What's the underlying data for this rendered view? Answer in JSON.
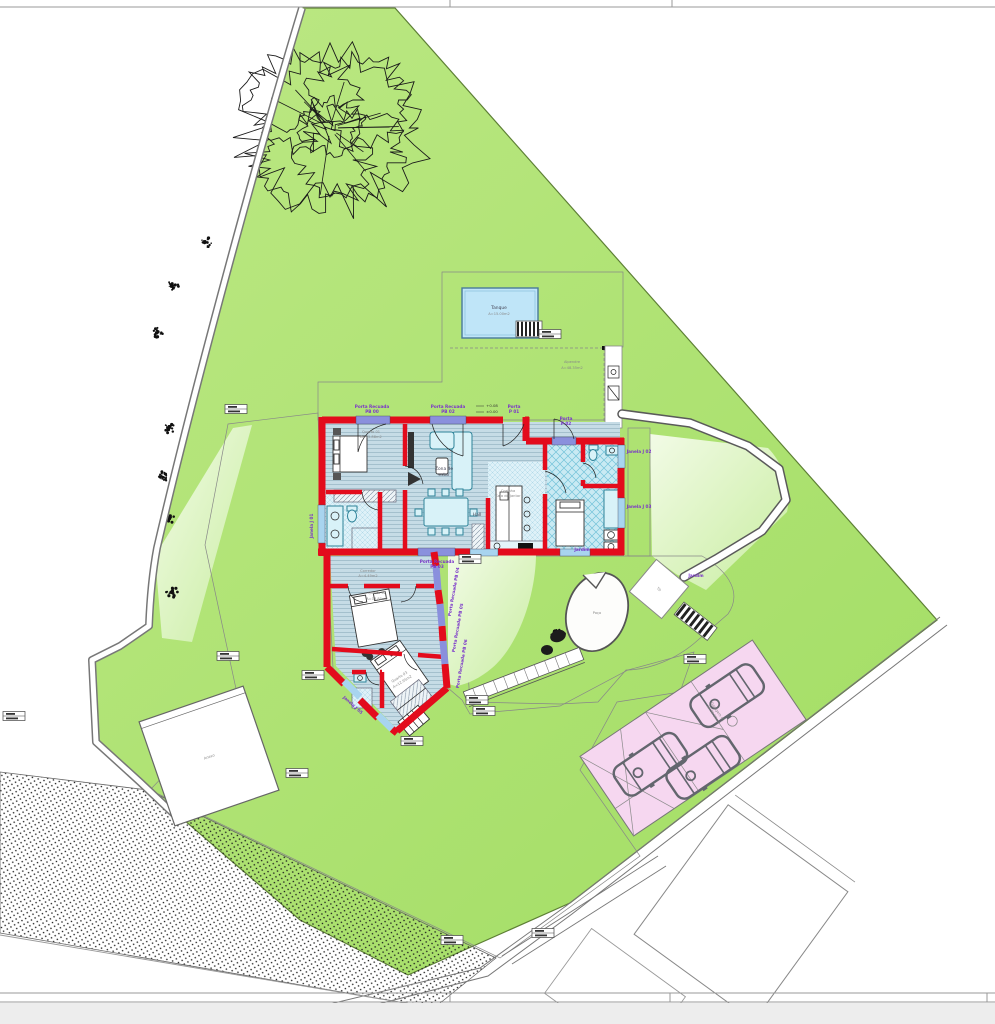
{
  "labels": {
    "pool_name": "Tanque",
    "pool_area": "A=15.00m2",
    "alpendre": "Alpendre",
    "alpendre_area": "A=48.35m2",
    "quarto1": "Quarto 01",
    "quarto1_area": "A=15.88m2",
    "zona1": "Zona de",
    "zona2": "estar",
    "hall": "Hall",
    "coz1": "Cozinha",
    "coz2": "Sala de Jantar",
    "corredor": "Corredor",
    "corredor_area": "A=4.49m2",
    "quarto2": "Quarto 02",
    "quarto2_area": "A=13.85m2",
    "quarto3": "Quarto 03",
    "quarto3_area": "A=12.95m2",
    "poco": "Poço",
    "t0": "T0",
    "anexo": "Anexo",
    "jardim_a": "Jardim",
    "jardim_b": "Jardim",
    "lvl_up": "+0.08",
    "lvl_dn": "±0.00",
    "garagem": "Garagem 01",
    "garagem_area": "A=36.60m2",
    "d_pb00_1": "Porta Recuada",
    "d_pb00_2": "PB 00",
    "d_pb02_1": "Porta Recuada",
    "d_pb02_2": "PB 02",
    "d_p01_1": "Porta",
    "d_p01_2": "P 01",
    "d_p02_1": "Porta",
    "d_p02_2": "P 02",
    "d_pb03_1": "Porta Recuada",
    "d_pb03_2": "PB 03",
    "d_pb04": "Porta Recuada PB 04",
    "d_pb05": "Porta Recuada PB 05",
    "d_pb06": "Porta Recuada PB 06",
    "w_j01": "Janela J 01",
    "w_j02": "Janela J 02",
    "w_j03": "Janela J 03",
    "w_j05": "Janela J 05"
  },
  "colors": {
    "wall_red": "#e30b1c",
    "lawn": "#aee172",
    "lawn_light": "#ecf8da",
    "pool_blue": "#bfe5f8",
    "parking_pink": "#f6d7f0",
    "door_band": "#8a90dd",
    "window_band": "#a8d4ef",
    "furniture_teal": "#2e8399",
    "label_purple": "#7a35c9",
    "deck_dark": "#97999b",
    "deck_light": "#f0f0ee"
  }
}
